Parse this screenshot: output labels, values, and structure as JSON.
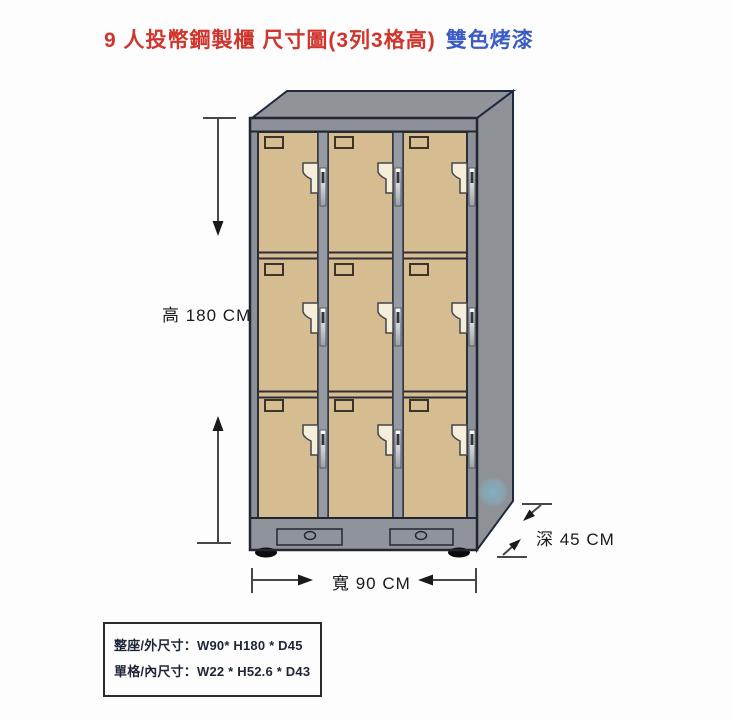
{
  "title": {
    "main": "9 人投幣鋼製櫃 尺寸圖(3列3格高)",
    "sub": "雙色烤漆"
  },
  "diagram": {
    "height_label": "高 180 CM",
    "width_label": "寬 90 CM",
    "depth_label": "深 45 CM",
    "cabinet": {
      "columns": 3,
      "rows": 3,
      "lockers": 9,
      "door_color": "#d5bc91",
      "frame_color": "#8c9099",
      "top_color": "#909398",
      "side_color": "#8e9196",
      "base_color": "#8f949c",
      "divider_color": "#969aa2",
      "outline_color": "#23262e",
      "lock_color": "#f4eeda",
      "foot_color": "#0c0c0e"
    }
  },
  "spec_box": {
    "line1": "整座/外尺寸：W90* H180 * D45",
    "line2": "單格/內尺寸：W22 * H52.6 * D43"
  },
  "colors": {
    "title_red": "#d0342c",
    "title_blue": "#3c5cc5",
    "dimension_line": "#46474b",
    "watermark_blue": "#7fc0d8"
  }
}
